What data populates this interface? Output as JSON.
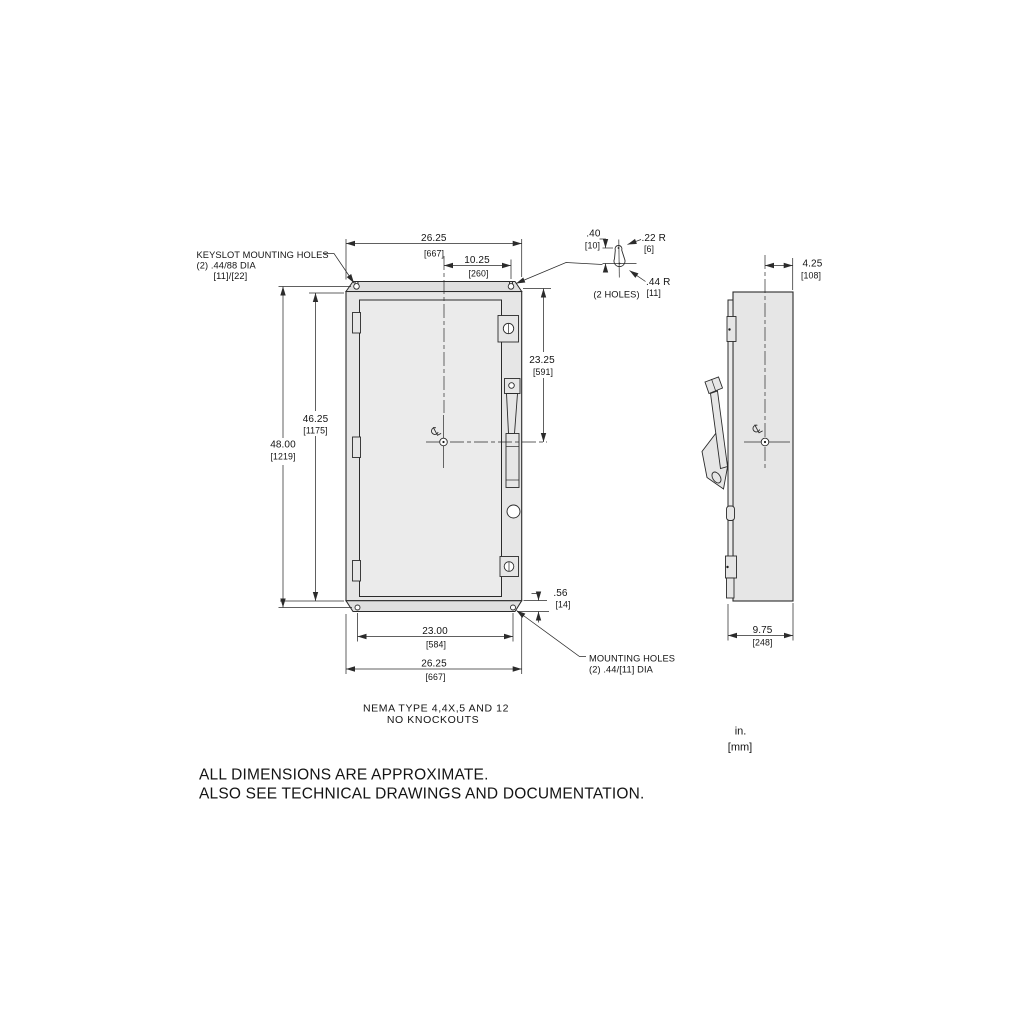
{
  "page": {
    "background": "#ffffff",
    "line_color": "#2b2b2b",
    "body_fill": "#e6e6e6"
  },
  "drawing": {
    "front_view": {
      "dims": {
        "top_width": {
          "in": "26.25",
          "mm": "[667]"
        },
        "keyslot_offset": {
          "in": "10.25",
          "mm": "[260]"
        },
        "overall_height": {
          "in": "48.00",
          "mm": "[1219]"
        },
        "panel_height": {
          "in": "46.25",
          "mm": "[1175]"
        },
        "center_height": {
          "in": "23.25",
          "mm": "[591]"
        },
        "hole_span": {
          "in": "23.00",
          "mm": "[584]"
        },
        "bottom_width": {
          "in": "26.25",
          "mm": "[667]"
        },
        "hole_offset": {
          "in": ".56",
          "mm": "[14]"
        }
      },
      "labels": {
        "keyslot_line1": "KEYSLOT MOUNTING HOLES",
        "keyslot_line2": "(2) .44/88 DIA",
        "keyslot_line3": "[11]/[22]",
        "mounting_line1": "MOUNTING HOLES",
        "mounting_line2": "(2) .44/[11] DIA"
      },
      "caption_line1": "NEMA TYPE 4,4X,5 AND 12",
      "caption_line2": "NO KNOCKOUTS"
    },
    "keyslot_detail": {
      "offset": {
        "in": ".40",
        "mm": "[10]"
      },
      "radius_small": {
        "in": ".22 R",
        "mm": "[6]"
      },
      "radius_large": {
        "in": ".44 R",
        "mm": "[11]"
      },
      "holes_note": "(2 HOLES)"
    },
    "side_view": {
      "dims": {
        "depth_front": {
          "in": "4.25",
          "mm": "[108]"
        },
        "depth_total": {
          "in": "9.75",
          "mm": "[248]"
        }
      }
    },
    "units_legend": {
      "inches": "in.",
      "millimeters": "[mm]"
    },
    "notes": {
      "line1": "ALL DIMENSIONS ARE APPROXIMATE.",
      "line2": "ALSO SEE TECHNICAL DRAWINGS AND DOCUMENTATION."
    }
  }
}
